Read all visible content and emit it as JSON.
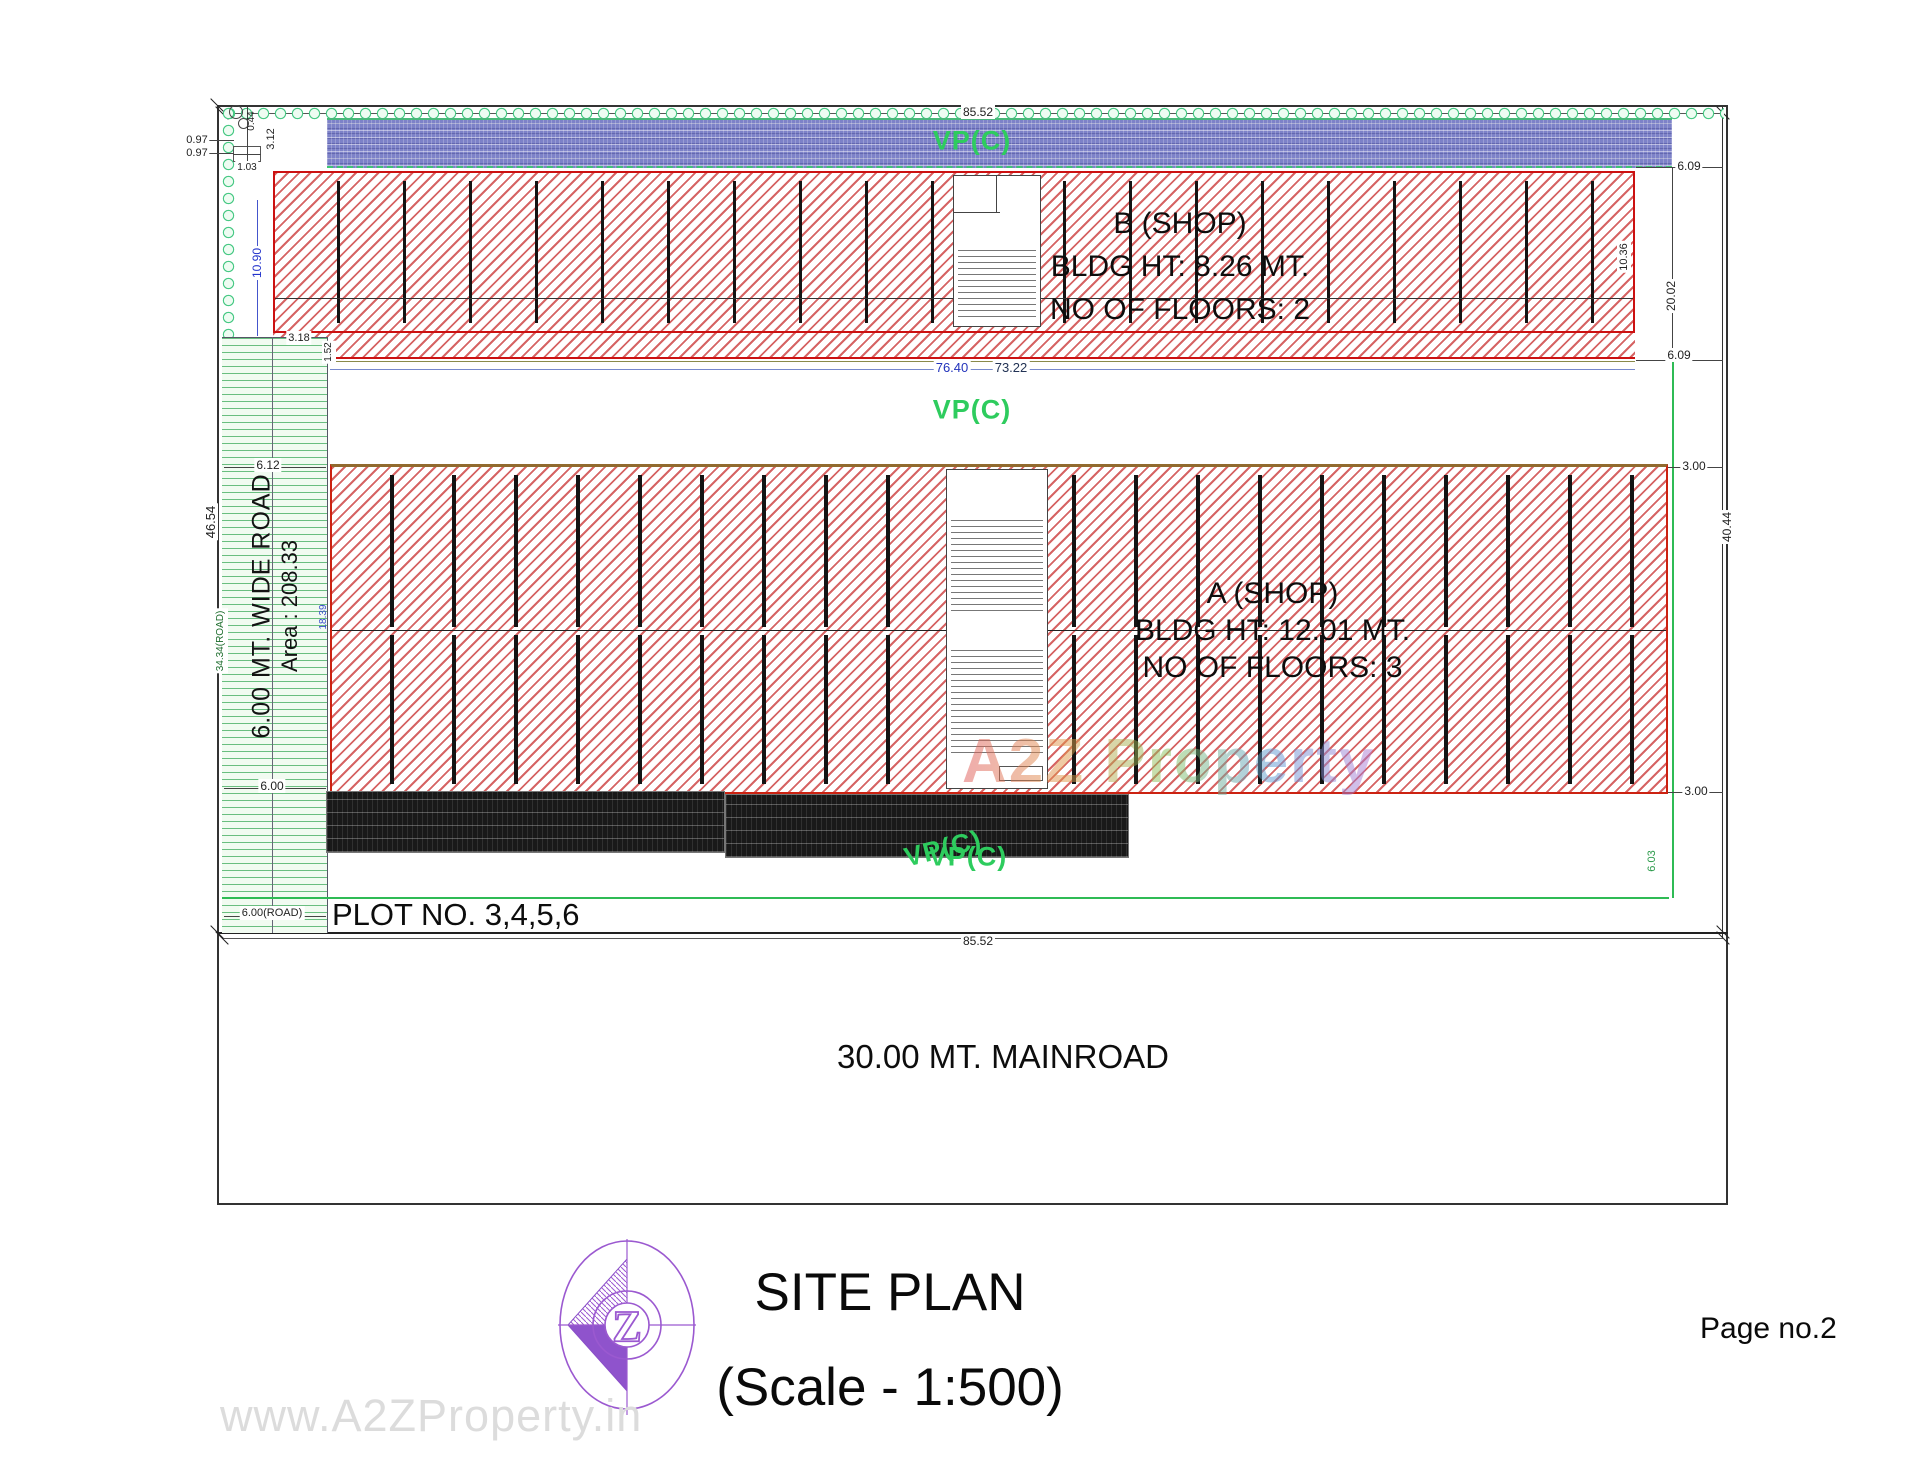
{
  "drawing": {
    "vp_labels": {
      "top": "VP(C)",
      "middle": "VP(C)",
      "bottom_a": "VP(C)",
      "bottom_b": "VP(C)"
    },
    "road": {
      "line1": "6.00 MT. WIDE ROAD",
      "line2": "Area : 208.33"
    },
    "plot_label": "PLOT NO. 3,4,5,6",
    "mainroad_label": "30.00 MT. MAINROAD",
    "building_b": {
      "name": "B (SHOP)",
      "height": "BLDG HT: 8.26 MT.",
      "floors": "NO OF FLOORS: 2"
    },
    "building_a": {
      "name": "A (SHOP)",
      "height": "BLDG HT: 12.01 MT.",
      "floors": "NO OF FLOORS: 3"
    },
    "dims": {
      "top_width": "85.52",
      "bottom_width": "85.52",
      "b_bottom_blue": "76.40",
      "b_bottom_black": "73.22",
      "right_gap_top": "6.09",
      "right_b_span": "20.02",
      "right_gap_mid": "6.09",
      "a_top_margin": "3.00",
      "a_span": "40.44",
      "a_bottom_margin": "3.00",
      "road_right": "6.03",
      "b_right_height": "10.36",
      "left_total": "46.54",
      "left_road": "34.34(ROAD)",
      "b_left_height": "10.90",
      "road_top": "6.12",
      "road_mid": "6.00",
      "road_bottom": "6.00(ROAD)",
      "corner_1": "0.97",
      "corner_2": "0.97",
      "corner_3": "3.12",
      "corner_4": "1.03",
      "corner_5": "0.44",
      "b_offset": "3.18",
      "b_offset2": "1.52",
      "a_left": "18.39"
    }
  },
  "title_block": {
    "title": "SITE PLAN",
    "scale": "(Scale - 1:500)",
    "page": "Page no.2",
    "logo_letter": "Z"
  },
  "watermark": {
    "center": "A2Z Property",
    "bottom": "www.A2ZProperty.in"
  },
  "colors": {
    "hatch_red": "#c62828",
    "strip_blue": "#7d82c8",
    "hedge_green": "#49c985",
    "vp_green": "#2ecc5e",
    "dim_blue": "#2233cc",
    "logo_purple": "#9b59d0"
  }
}
